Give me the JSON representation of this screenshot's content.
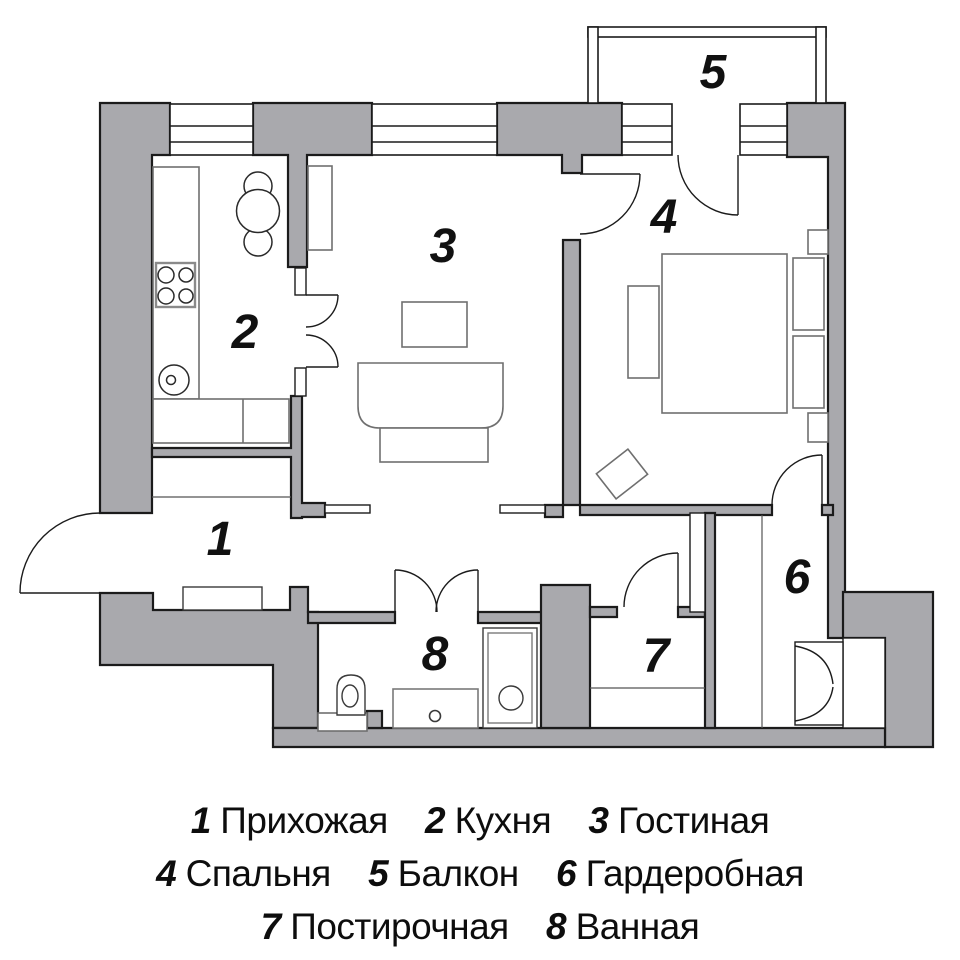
{
  "plan": {
    "wall_fill": "#a9a9ad",
    "wall_stroke": "#1b1b1b",
    "furniture_stroke": "#6f6f6f",
    "fixture_stroke": "#3a3a3a",
    "label_color": "#111111",
    "background": "#ffffff"
  },
  "rooms": [
    {
      "number": "1",
      "name": "Прихожая"
    },
    {
      "number": "2",
      "name": "Кухня"
    },
    {
      "number": "3",
      "name": "Гостиная"
    },
    {
      "number": "4",
      "name": "Спальня"
    },
    {
      "number": "5",
      "name": "Балкон"
    },
    {
      "number": "6",
      "name": "Гардеробная"
    },
    {
      "number": "7",
      "name": "Постирочная"
    },
    {
      "number": "8",
      "name": "Ванная"
    }
  ],
  "legend": {
    "lines": [
      [
        {
          "number": "1",
          "label": "Прихожая"
        },
        {
          "number": "2",
          "label": "Кухня"
        },
        {
          "number": "3",
          "label": "Гостиная"
        }
      ],
      [
        {
          "number": "4",
          "label": "Спальня"
        },
        {
          "number": "5",
          "label": "Балкон"
        },
        {
          "number": "6",
          "label": "Гардеробная"
        }
      ],
      [
        {
          "number": "7",
          "label": "Постирочная"
        },
        {
          "number": "8",
          "label": "Ванная"
        }
      ]
    ]
  }
}
